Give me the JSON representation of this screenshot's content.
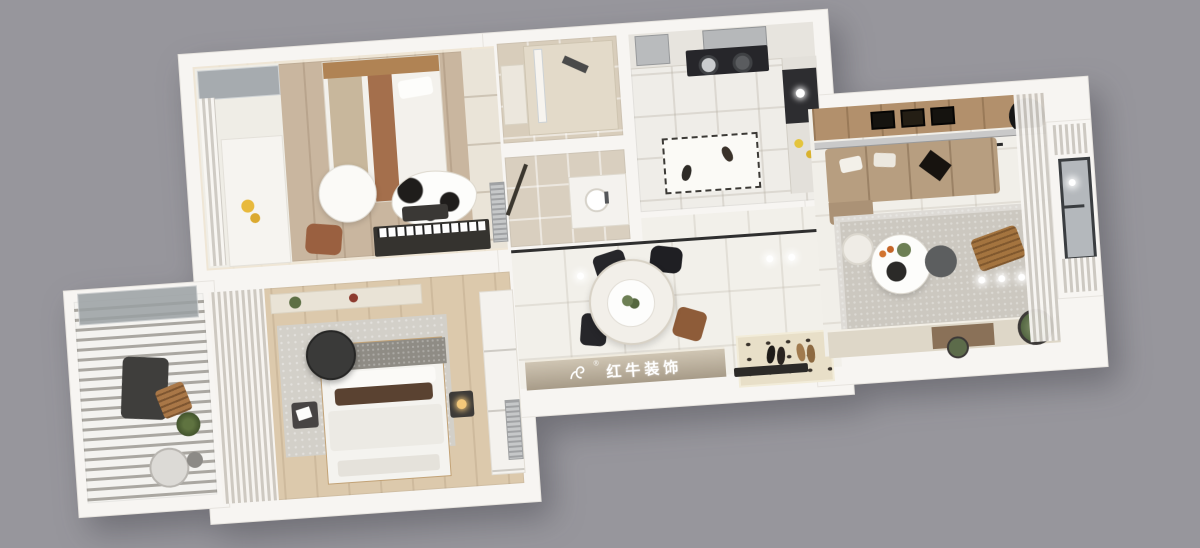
{
  "scene": {
    "render_type": "3d-top-down-apartment-floorplan-render",
    "background_color": "#97969c",
    "watermark": {
      "icon": "bull-logo-icon",
      "registered_mark": "®",
      "text": "红牛装饰",
      "band_color": "#b3a794",
      "text_color": "#ffffff"
    }
  },
  "palette": {
    "wall_white": "#f7f5f2",
    "bedroom_wood_floor": "#c9b69f",
    "master_wood_floor": "#dcc9ac",
    "bathroom_tile": "#d8cdbb",
    "hall_tile": "#f2f0ea",
    "living_rug": "#ccc8c0",
    "master_rug": "#d3d0c9",
    "sofa_tan": "#b79e80",
    "wood_accent_wall": "#b2906c",
    "pendant_black": "#3a3a39",
    "curtain_sheer": "#e9e6e0",
    "balcony_slats": "#b4b1ab"
  },
  "rooms": [
    {
      "name": "secondary-bedroom",
      "floor": "wood-planks",
      "furniture": [
        "single-bed",
        "wood-headboard",
        "round-paper-pendant-lamp",
        "cow-pattern-rug",
        "upright-piano",
        "piano-bench",
        "brown-armchair",
        "wardrobe",
        "dressing-nook",
        "window-seat",
        "sheer-curtain"
      ]
    },
    {
      "name": "master-bedroom",
      "floor": "light-wood-planks",
      "furniture": [
        "double-bed",
        "fabric-headboard",
        "black-round-pendant-lamp",
        "gray-area-rug",
        "nightstand-left",
        "nightstand-right",
        "sheer-curtains",
        "sliding-wardrobe",
        "wall-shelf",
        "foot-bench"
      ]
    },
    {
      "name": "shower-bathroom",
      "floor": "beige-tile",
      "furniture": [
        "walk-in-shower",
        "glass-screen",
        "shower-fixture",
        "vanity"
      ]
    },
    {
      "name": "washroom",
      "floor": "beige-tile",
      "furniture": [
        "washbasin-vanity",
        "door-leaf"
      ]
    },
    {
      "name": "kitchen",
      "floor": "tile",
      "furniture": [
        "range-hood",
        "black-cooktop",
        "refrigerator",
        "upper-counter",
        "side-counter",
        "dark-counter-section",
        "kitchen-mat",
        "slippers",
        "condiment-bottles"
      ]
    },
    {
      "name": "dining-hall",
      "floor": "porcelain-tile",
      "furniture": [
        "round-marble-dining-table",
        "pendant-lamp",
        "black-dining-chairs",
        "brown-dining-chair",
        "threshold-track",
        "entry-mat",
        "shoes",
        "branded-sideboard",
        "downlights"
      ]
    },
    {
      "name": "living-room",
      "floor": "porcelain-tile",
      "furniture": [
        "tan-fabric-sofa",
        "throw-pillows",
        "wood-accent-wall",
        "picture-frames",
        "wall-disc-decor",
        "metal-ledge",
        "linear-black-pendant",
        "gray-area-rug",
        "round-white-coffee-table",
        "decor-tray",
        "dark-side-table",
        "knit-pouf",
        "wood-lounge-chair",
        "tv-cabinet",
        "potted-plant-large",
        "potted-plant-small",
        "sheer-curtains",
        "bay-window",
        "downlights"
      ]
    },
    {
      "name": "louvered-balcony",
      "floor": "white-decking",
      "furniture": [
        "louvered-pergola-slats",
        "glass-panel",
        "dark-lounge-chair",
        "folding-wood-chair",
        "potted-plant",
        "round-lounge-egg-chair",
        "side-table"
      ]
    }
  ]
}
